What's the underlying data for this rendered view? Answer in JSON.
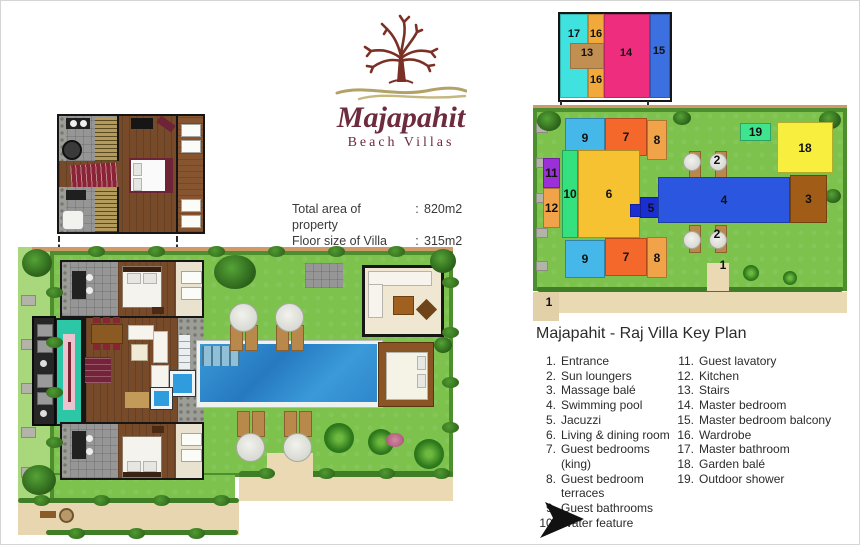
{
  "logo": {
    "name": "Majapahit",
    "tagline": "Beach Villas"
  },
  "property_info": {
    "rows": [
      {
        "label": "Total area of  property",
        "separator": ":",
        "value": "820m2"
      },
      {
        "label": "Floor size of Villa",
        "separator": ":",
        "value": "315m2"
      }
    ]
  },
  "legend": {
    "title": "Majapahit - Raj Villa Key Plan",
    "columns": [
      {
        "items": [
          {
            "num": "1.",
            "label": "Entrance"
          },
          {
            "num": "2.",
            "label": "Sun loungers"
          },
          {
            "num": "3.",
            "label": "Massage balé"
          },
          {
            "num": "4.",
            "label": "Swimming pool"
          },
          {
            "num": "5.",
            "label": "Jacuzzi"
          },
          {
            "num": "6.",
            "label": "Living & dining room"
          },
          {
            "num": "7.",
            "label": "Guest bedrooms (king)"
          },
          {
            "num": "8.",
            "label": "Guest bedroom terraces"
          },
          {
            "num": "9.",
            "label": "Guest bathrooms"
          },
          {
            "num": "10.",
            "label": "Water feature"
          }
        ]
      },
      {
        "items": [
          {
            "num": "11.",
            "label": "Guest lavatory"
          },
          {
            "num": "12.",
            "label": "Kitchen"
          },
          {
            "num": "13.",
            "label": "Stairs"
          },
          {
            "num": "14.",
            "label": "Master bedroom"
          },
          {
            "num": "15.",
            "label": "Master bedroom balcony"
          },
          {
            "num": "16.",
            "label": "Wardrobe"
          },
          {
            "num": "17.",
            "label": "Master bathroom"
          },
          {
            "num": "18.",
            "label": "Garden balé"
          },
          {
            "num": "19.",
            "label": "Outdoor shower"
          }
        ]
      }
    ]
  },
  "key_plan": {
    "inset": {
      "blocks": [
        {
          "name": "master-bathroom-17",
          "x": 0,
          "y": 0,
          "w": 28,
          "h": 84,
          "bg": "#3fe2de"
        },
        {
          "name": "wardrobe-16",
          "x": 28,
          "y": 0,
          "w": 16,
          "h": 84,
          "bg": "#f2a93c"
        },
        {
          "name": "master-bedroom-14",
          "x": 44,
          "y": 0,
          "w": 46,
          "h": 84,
          "bg": "#ee2d7f"
        },
        {
          "name": "balcony-15",
          "x": 90,
          "y": 0,
          "w": 20,
          "h": 84,
          "bg": "#3c6fe0"
        },
        {
          "name": "stairs-13",
          "x": 10,
          "y": 29,
          "w": 34,
          "h": 26,
          "bg": "#c28f52"
        }
      ],
      "labels": [
        {
          "text": "17",
          "x": 2,
          "y": 14
        },
        {
          "text": "16",
          "x": 24,
          "y": 14
        },
        {
          "text": "13",
          "x": 15,
          "y": 33
        },
        {
          "text": "14",
          "x": 54,
          "y": 33
        },
        {
          "text": "15",
          "x": 87,
          "y": 31
        },
        {
          "text": "16",
          "x": 24,
          "y": 60
        }
      ]
    },
    "main": {
      "blocks": [
        {
          "text": "9",
          "x": 32,
          "y": 15,
          "w": 40,
          "h": 40,
          "bg": "#45b7e8"
        },
        {
          "text": "7",
          "x": 72,
          "y": 15,
          "w": 42,
          "h": 38,
          "bg": "#f4692b"
        },
        {
          "text": "8",
          "x": 114,
          "y": 17,
          "w": 20,
          "h": 40,
          "bg": "#f0a348"
        },
        {
          "text": "11",
          "x": 10,
          "y": 55,
          "w": 17,
          "h": 30,
          "bg": "#9b30d9"
        },
        {
          "text": "12",
          "x": 10,
          "y": 85,
          "w": 17,
          "h": 40,
          "bg": "#f0a348"
        },
        {
          "text": "10",
          "x": 29,
          "y": 47,
          "w": 16,
          "h": 88,
          "bg": "#35e07e"
        },
        {
          "text": "6",
          "x": 45,
          "y": 47,
          "w": 62,
          "h": 88,
          "bg": "#f6c231"
        },
        {
          "text": "",
          "x": 97,
          "y": 101,
          "w": 13,
          "h": 13,
          "bg": "#1b2ed1"
        },
        {
          "text": "5",
          "x": 107,
          "y": 94,
          "w": 22,
          "h": 21,
          "bg": "#1b2ed1"
        },
        {
          "text": "4",
          "x": 125,
          "y": 74,
          "w": 132,
          "h": 46,
          "bg": "#2b57e0"
        },
        {
          "text": "3",
          "x": 257,
          "y": 72,
          "w": 37,
          "h": 48,
          "bg": "#a15c17"
        },
        {
          "text": "18",
          "x": 244,
          "y": 19,
          "w": 56,
          "h": 51,
          "bg": "#f7ee3d"
        },
        {
          "text": "19",
          "x": 207,
          "y": 20,
          "w": 31,
          "h": 18,
          "bg": "#3fe48f"
        },
        {
          "text": "9",
          "x": 32,
          "y": 137,
          "w": 40,
          "h": 38,
          "bg": "#45b7e8"
        },
        {
          "text": "7",
          "x": 72,
          "y": 135,
          "w": 42,
          "h": 38,
          "bg": "#f4692b"
        },
        {
          "text": "8",
          "x": 114,
          "y": 134,
          "w": 20,
          "h": 41,
          "bg": "#f0a348"
        }
      ],
      "labels": [
        {
          "text": "2",
          "x": 172,
          "y": 50
        },
        {
          "text": "2",
          "x": 172,
          "y": 124
        },
        {
          "text": "1",
          "x": 178,
          "y": 155
        },
        {
          "text": "1",
          "x": 4,
          "y": 192
        }
      ]
    }
  }
}
